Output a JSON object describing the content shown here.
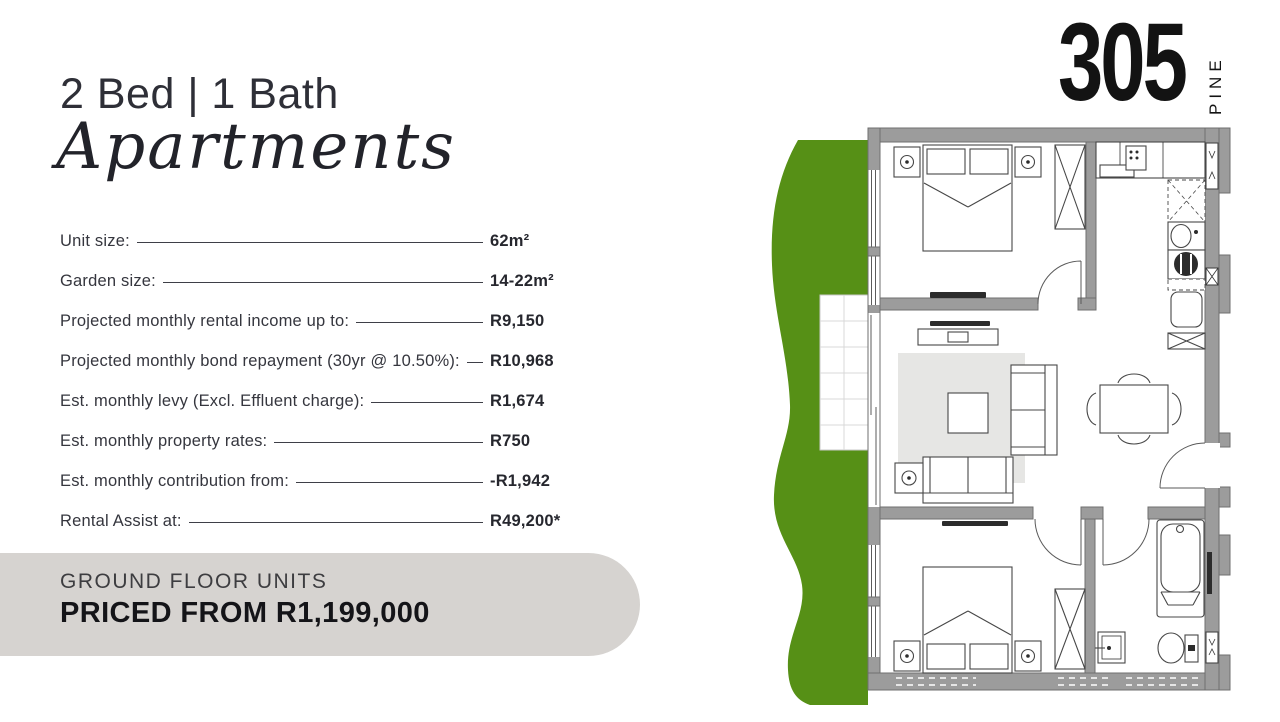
{
  "header": {
    "title": "2 Bed | 1 Bath",
    "subtitle": "Apartments"
  },
  "logo": {
    "number": "305",
    "name": "PINE"
  },
  "specs": [
    {
      "label": "Unit size:",
      "value": "62m²"
    },
    {
      "label": "Garden size:",
      "value": "14-22m²"
    },
    {
      "label": "Projected monthly rental income up to:",
      "value": "R9,150"
    },
    {
      "label": "Projected monthly bond repayment (30yr @ 10.50%):",
      "value": "R10,968"
    },
    {
      "label": "Est. monthly levy (Excl. Effluent charge):",
      "value": "R1,674"
    },
    {
      "label": "Est. monthly property rates:",
      "value": "R750"
    },
    {
      "label": "Est. monthly contribution from:",
      "value": "-R1,942"
    },
    {
      "label": "Rental Assist at:",
      "value": "R49,200*"
    }
  ],
  "price_box": {
    "line1": "GROUND FLOOR UNITS",
    "line2": "PRICED FROM R1,199,000"
  },
  "colors": {
    "garden_green": "#569016",
    "wall_gray": "#9c9c9c",
    "rug_gray": "#e6e6e4",
    "price_box_bg": "#d6d3d0",
    "text_dark": "#2b2c33"
  }
}
